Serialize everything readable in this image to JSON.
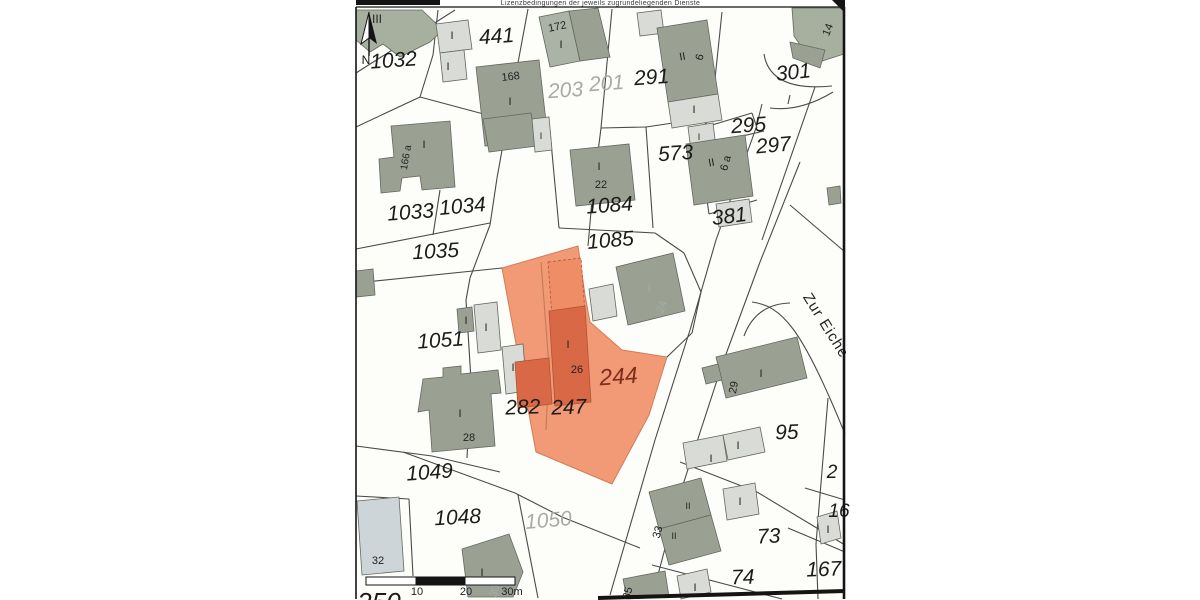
{
  "header": {
    "license_text": "Lizenzbedingungen der jeweils zugrundeliegenden Dienste"
  },
  "map": {
    "street_label": {
      "t": "Zur Eiche",
      "x": 822,
      "y": 328,
      "r": 58,
      "s": 15
    },
    "north": {
      "t": "N",
      "x": 366,
      "y": 64
    },
    "highlight_parcel": {
      "number": "244",
      "points": "502,268 578,246 585,295 590,322 622,350 667,357 649,415 612,484 536,452"
    },
    "palette": {
      "dark": "#9aa193",
      "light": "#d9dbd6",
      "lighter": "#e4e5e2",
      "green": "#a7b09e",
      "green2": "#aab3a5",
      "blue": "#cdd5d9",
      "orange": "#f29a76",
      "orange_dark": "#d96847",
      "orange_mid": "#ee8d66",
      "line": "#4a4a48",
      "label": "#1b1b1b",
      "faded": "#a9aaa5",
      "red": "#7e2c1c",
      "frame": "#141414"
    },
    "parcel_labels": [
      {
        "t": "1032",
        "x": 394,
        "y": 67,
        "r": -4
      },
      {
        "t": "441",
        "x": 497,
        "y": 43,
        "r": -4
      },
      {
        "t": "203",
        "x": 566,
        "y": 97,
        "r": -4,
        "c": "faded"
      },
      {
        "t": "201",
        "x": 607,
        "y": 90,
        "r": -4,
        "c": "faded"
      },
      {
        "t": "291",
        "x": 652,
        "y": 84,
        "r": -4
      },
      {
        "t": "301",
        "x": 794,
        "y": 79,
        "r": -6
      },
      {
        "t": "295",
        "x": 749,
        "y": 132,
        "r": -4
      },
      {
        "t": "297",
        "x": 774,
        "y": 152,
        "r": -5
      },
      {
        "t": "1033",
        "x": 411,
        "y": 219,
        "r": -4
      },
      {
        "t": "1034",
        "x": 463,
        "y": 213,
        "r": -5
      },
      {
        "t": "1084",
        "x": 610,
        "y": 212,
        "r": -4
      },
      {
        "t": "573",
        "x": 676,
        "y": 160,
        "r": -4
      },
      {
        "t": "381",
        "x": 730,
        "y": 223,
        "r": -7
      },
      {
        "t": "1035",
        "x": 436,
        "y": 258,
        "r": -3
      },
      {
        "t": "1085",
        "x": 611,
        "y": 247,
        "r": -5
      },
      {
        "t": "1051",
        "x": 441,
        "y": 347,
        "r": -4
      },
      {
        "t": "244",
        "x": 619,
        "y": 384,
        "r": -4,
        "c": "red",
        "s": 23
      },
      {
        "t": "282",
        "x": 523,
        "y": 414,
        "r": -2
      },
      {
        "t": "247",
        "x": 569,
        "y": 414,
        "r": -2
      },
      {
        "t": "95",
        "x": 787,
        "y": 439,
        "r": -2
      },
      {
        "t": "73",
        "x": 769,
        "y": 543,
        "r": -3
      },
      {
        "t": "74",
        "x": 743,
        "y": 584,
        "r": -2
      },
      {
        "t": "167",
        "x": 824,
        "y": 576,
        "r": -2
      },
      {
        "t": "1049",
        "x": 430,
        "y": 479,
        "r": -4
      },
      {
        "t": "1048",
        "x": 458,
        "y": 524,
        "r": -3
      },
      {
        "t": "1050",
        "x": 549,
        "y": 527,
        "r": -5,
        "c": "faded"
      },
      {
        "t": "2",
        "x": 832,
        "y": 478,
        "s": 19
      },
      {
        "t": "16",
        "x": 839,
        "y": 517,
        "s": 19
      },
      {
        "t": "250",
        "x": 379,
        "y": 611,
        "s": 26
      }
    ],
    "building_labels": [
      {
        "t": "III",
        "x": 377,
        "y": 23,
        "s": 12
      },
      {
        "t": "172",
        "x": 558,
        "y": 30,
        "r": -12
      },
      {
        "t": "I",
        "x": 561,
        "y": 48
      },
      {
        "t": "168",
        "x": 511,
        "y": 80,
        "r": -6
      },
      {
        "t": "I",
        "x": 510,
        "y": 105
      },
      {
        "t": "II",
        "x": 683,
        "y": 60,
        "r": -10
      },
      {
        "t": "6",
        "x": 703,
        "y": 58,
        "r": -75
      },
      {
        "t": "I",
        "x": 694,
        "y": 113
      },
      {
        "t": "I",
        "x": 699,
        "y": 140,
        "s": 9
      },
      {
        "t": "14",
        "x": 831,
        "y": 31,
        "r": -68
      },
      {
        "t": "I",
        "x": 452,
        "y": 39
      },
      {
        "t": "I",
        "x": 448,
        "y": 70
      },
      {
        "t": "166 a",
        "x": 409,
        "y": 158,
        "r": -80,
        "s": 10
      },
      {
        "t": "I",
        "x": 424,
        "y": 148
      },
      {
        "t": "I",
        "x": 541,
        "y": 139,
        "s": 9
      },
      {
        "t": "I",
        "x": 599,
        "y": 170
      },
      {
        "t": "22",
        "x": 601,
        "y": 188
      },
      {
        "t": "II",
        "x": 712,
        "y": 166,
        "r": -10
      },
      {
        "t": "6 a",
        "x": 729,
        "y": 164,
        "r": -75
      },
      {
        "t": "I",
        "x": 733,
        "y": 216
      },
      {
        "t": "I",
        "x": 466,
        "y": 324
      },
      {
        "t": "I",
        "x": 486,
        "y": 331
      },
      {
        "t": "I",
        "x": 513,
        "y": 371
      },
      {
        "t": "I",
        "x": 460,
        "y": 417
      },
      {
        "t": "28",
        "x": 469,
        "y": 441
      },
      {
        "t": "I",
        "x": 568,
        "y": 348
      },
      {
        "t": "26",
        "x": 577,
        "y": 373
      },
      {
        "t": "I",
        "x": 649,
        "y": 292,
        "c": "faded"
      },
      {
        "t": "24",
        "x": 665,
        "y": 308,
        "r": -70,
        "c": "faded"
      },
      {
        "t": "29",
        "x": 737,
        "y": 388,
        "r": -80
      },
      {
        "t": "I",
        "x": 761,
        "y": 377
      },
      {
        "t": "32",
        "x": 378,
        "y": 564
      },
      {
        "t": "I",
        "x": 482,
        "y": 576
      },
      {
        "t": "30",
        "x": 498,
        "y": 592,
        "r": -75,
        "c": "faded"
      },
      {
        "t": "I",
        "x": 711,
        "y": 462
      },
      {
        "t": "I",
        "x": 738,
        "y": 449
      },
      {
        "t": "I",
        "x": 740,
        "y": 505
      },
      {
        "t": "II",
        "x": 688,
        "y": 509,
        "s": 9
      },
      {
        "t": "33",
        "x": 661,
        "y": 533,
        "r": -75
      },
      {
        "t": "II",
        "x": 674,
        "y": 539,
        "s": 9
      },
      {
        "t": "I",
        "x": 695,
        "y": 591
      },
      {
        "t": "35",
        "x": 631,
        "y": 594,
        "r": -75
      },
      {
        "t": "I",
        "x": 828,
        "y": 533
      }
    ],
    "buildings": [
      {
        "pts": "356,10 422,10 443,30 430,42 400,57 383,44 370,52 356,40",
        "f": "green"
      },
      {
        "pts": "436,24 468,20 472,49 440,53",
        "f": "light"
      },
      {
        "pts": "440,53 464,50 467,79 443,82",
        "f": "light"
      },
      {
        "pts": "476,67 539,60 548,139 485,146",
        "f": "dark"
      },
      {
        "pts": "539,17 569,11 580,61 550,67",
        "f": "green2"
      },
      {
        "pts": "569,11 598,8 610,57 580,61",
        "f": "dark"
      },
      {
        "pts": "637,13 661,10 664,33 640,36",
        "f": "light"
      },
      {
        "pts": "657,28 707,20 718,94 668,102",
        "f": "dark"
      },
      {
        "pts": "668,102 718,94 722,120 672,128",
        "f": "light"
      },
      {
        "pts": "688,127 713,123 716,147 691,151",
        "f": "light"
      },
      {
        "pts": "792,8 844,8 844,54 813,64 794,36",
        "f": "green"
      },
      {
        "pts": "790,42 825,50 820,68 793,58",
        "f": "dark"
      },
      {
        "pts": "391,126 450,121 455,187 422,190 420,176 402,178 400,191 381,193 379,159 394,157",
        "f": "dark"
      },
      {
        "pts": "483,119 531,113 537,146 489,152",
        "f": "dark"
      },
      {
        "pts": "532,119 549,117 552,150 535,152",
        "f": "light"
      },
      {
        "pts": "570,150 629,144 635,200 576,206",
        "f": "dark"
      },
      {
        "pts": "686,144 745,135 753,196 694,205",
        "f": "dark"
      },
      {
        "pts": "716,204 749,199 752,222 719,227",
        "f": "light"
      },
      {
        "pts": "356,271 373,269 375,295 356,297",
        "f": "dark"
      },
      {
        "pts": "457,309 472,307 474,331 459,333",
        "f": "dark"
      },
      {
        "pts": "474,305 497,302 501,350 478,353",
        "f": "light"
      },
      {
        "pts": "502,347 523,344 527,391 506,394",
        "f": "light"
      },
      {
        "pts": "423,379 443,377 443,368 461,366 461,374 498,370 501,393 491,394 495,446 432,452 429,410 418,412",
        "f": "dark"
      },
      {
        "pts": "589,289 613,284 617,316 593,321",
        "f": "light"
      },
      {
        "pts": "616,267 673,253 685,311 628,325",
        "f": "dark"
      },
      {
        "pts": "716,357 797,337 807,378 726,398",
        "f": "dark"
      },
      {
        "pts": "702,368 718,364 722,380 706,384",
        "f": "dark"
      },
      {
        "pts": "357,501 399,497 404,571 362,575",
        "f": "blue"
      },
      {
        "pts": "462,549 509,534 523,572 513,597 468,597",
        "f": "dark"
      },
      {
        "pts": "683,443 723,435 727,461 687,469",
        "f": "light"
      },
      {
        "pts": "723,435 760,427 765,452 728,460",
        "f": "light"
      },
      {
        "pts": "723,489 755,483 759,514 727,520",
        "f": "light"
      },
      {
        "pts": "649,492 701,478 711,515 659,529",
        "f": "dark"
      },
      {
        "pts": "659,529 711,515 721,551 669,565",
        "f": "dark"
      },
      {
        "pts": "677,576 707,569 711,592 681,599",
        "f": "light"
      },
      {
        "pts": "623,579 665,571 669,597 627,599",
        "f": "dark"
      },
      {
        "pts": "817,517 837,511 841,538 821,544",
        "f": "light"
      },
      {
        "pts": "827,188 840,186 841,203 829,205",
        "f": "dark"
      },
      {
        "pts": "548,262 581,258 585,313 552,317",
        "f": "orange_mid",
        "dash": true
      },
      {
        "pts": "549,311 585,306 591,402 555,406",
        "f": "orange_dark"
      },
      {
        "pts": "515,362 549,358 552,404 518,408",
        "f": "orange_dark"
      }
    ],
    "lines": [
      [
        356,
        73,
        455,
        10
      ],
      [
        438,
        10,
        433,
        55
      ],
      [
        433,
        55,
        420,
        97
      ],
      [
        356,
        127,
        420,
        97
      ],
      [
        420,
        97,
        476,
        112
      ],
      [
        476,
        112,
        545,
        130
      ],
      [
        528,
        9,
        512,
        95
      ],
      [
        512,
        95,
        497,
        178
      ],
      [
        497,
        178,
        490,
        225
      ],
      [
        490,
        225,
        470,
        278
      ],
      [
        470,
        278,
        466,
        300
      ],
      [
        612,
        9,
        601,
        128
      ],
      [
        601,
        128,
        592,
        200
      ],
      [
        592,
        200,
        588,
        246
      ],
      [
        601,
        128,
        646,
        127
      ],
      [
        646,
        127,
        700,
        119
      ],
      [
        722,
        12,
        711,
        117
      ],
      [
        711,
        117,
        702,
        128
      ],
      [
        702,
        128,
        752,
        113
      ],
      [
        752,
        113,
        757,
        128
      ],
      [
        713,
        143,
        764,
        131
      ],
      [
        356,
        249,
        490,
        223
      ],
      [
        440,
        190,
        433,
        235
      ],
      [
        356,
        283,
        502,
        268
      ],
      [
        550,
        131,
        559,
        228
      ],
      [
        559,
        228,
        655,
        233
      ],
      [
        646,
        127,
        653,
        228
      ],
      [
        700,
        150,
        709,
        214
      ],
      [
        709,
        214,
        757,
        200
      ],
      [
        655,
        233,
        684,
        253
      ],
      [
        684,
        253,
        701,
        292
      ],
      [
        701,
        292,
        692,
        333
      ],
      [
        692,
        333,
        667,
        357
      ],
      [
        466,
        300,
        471,
        380
      ],
      [
        471,
        380,
        467,
        458
      ],
      [
        356,
        446,
        432,
        456
      ],
      [
        432,
        456,
        500,
        472
      ],
      [
        356,
        496,
        409,
        499
      ],
      [
        409,
        499,
        413,
        576
      ],
      [
        403,
        452,
        515,
        493
      ],
      [
        515,
        493,
        562,
        517
      ],
      [
        562,
        517,
        640,
        548
      ],
      [
        518,
        495,
        538,
        598
      ],
      [
        680,
        462,
        757,
        492
      ],
      [
        757,
        492,
        845,
        545
      ],
      [
        652,
        565,
        782,
        599
      ],
      [
        788,
        528,
        845,
        552
      ],
      [
        828,
        398,
        816,
        544
      ],
      [
        816,
        544,
        818,
        599
      ],
      [
        805,
        488,
        845,
        500
      ],
      [
        815,
        87,
        762,
        240
      ],
      [
        790,
        205,
        845,
        252
      ],
      [
        756,
        128,
        762,
        104
      ],
      [
        756,
        128,
        716,
        240
      ],
      [
        716,
        240,
        690,
        330
      ],
      [
        690,
        330,
        655,
        440
      ],
      [
        655,
        440,
        610,
        595
      ],
      [
        800,
        162,
        760,
        262
      ],
      [
        760,
        262,
        722,
        365
      ],
      [
        722,
        365,
        678,
        500
      ],
      [
        678,
        500,
        652,
        597
      ],
      [
        790,
        95,
        788,
        104
      ]
    ],
    "curves": [
      {
        "d": "M764,54 Q770,92 832,86"
      },
      {
        "d": "M770,108 Q800,112 833,92"
      },
      {
        "d": "M752,302 C782,306 802,328 845,434"
      },
      {
        "d": "M744,336 Q756,304 790,303"
      },
      {
        "d": "M541,262 L549,366 L546,430",
        "c": "inner"
      }
    ],
    "frame": {
      "top_bar": [
        356,
        0,
        84,
        5
      ],
      "corner_wedge": "832,0 845,0 845,13 838,6",
      "top_line": [
        356,
        7,
        845,
        7
      ],
      "left_line": [
        356,
        7,
        356,
        599
      ],
      "right_line": [
        844,
        7,
        844,
        599
      ],
      "bottom_line": [
        598,
        598,
        845,
        591
      ]
    },
    "scalebar": {
      "x": 366,
      "y": 577,
      "h": 8,
      "segments": [
        [
          366,
          50,
          "#ffffff"
        ],
        [
          416,
          49,
          "#141414"
        ],
        [
          465,
          50,
          "#ffffff"
        ]
      ],
      "ticks": [
        {
          "t": "10",
          "x": 417
        },
        {
          "t": "20",
          "x": 466
        },
        {
          "t": "30m",
          "x": 512
        }
      ]
    }
  }
}
